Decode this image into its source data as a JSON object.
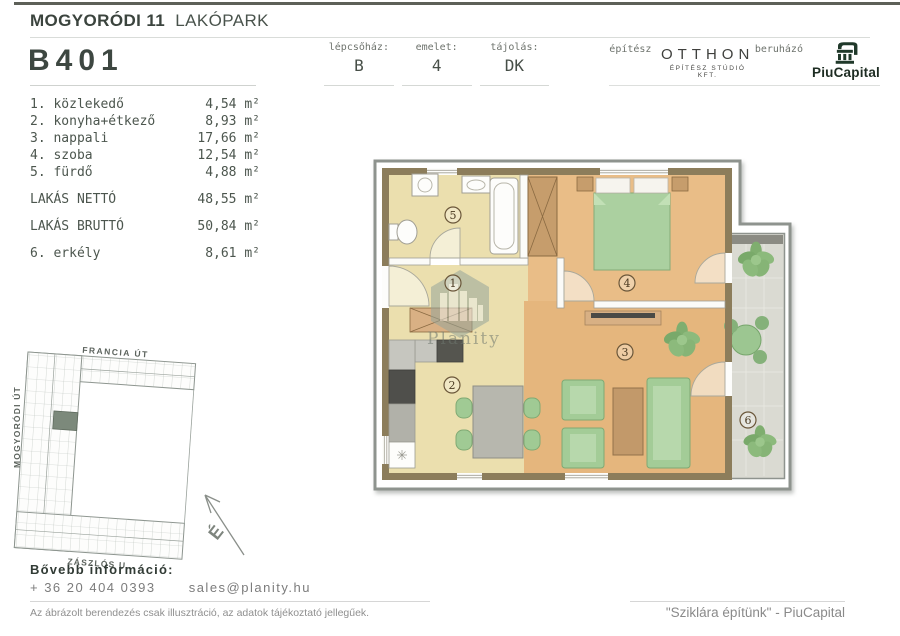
{
  "header": {
    "project_title_bold": "MOGYORÓDI 11",
    "project_title_light": "LAKÓPARK",
    "unit_id": "B401",
    "info": [
      {
        "label": "lépcsőház:",
        "value": "B"
      },
      {
        "label": "emelet:",
        "value": "4"
      },
      {
        "label": "tájolás:",
        "value": "DK"
      }
    ],
    "architect_label": "építész",
    "architect_name": "OTTHON",
    "architect_sub": "ÉPÍTÉSZ STÚDIÓ KFT.",
    "developer_label": "beruházó",
    "developer_name": "PiuCapital"
  },
  "areas": {
    "rooms": [
      {
        "label": "1. közlekedő",
        "area": "4,54 m²"
      },
      {
        "label": "2. konyha+étkező",
        "area": "8,93 m²"
      },
      {
        "label": "3. nappali",
        "area": "17,66 m²"
      },
      {
        "label": "4. szoba",
        "area": "12,54 m²"
      },
      {
        "label": "5. fürdő",
        "area": "4,88 m²"
      }
    ],
    "net": {
      "label": "LAKÁS NETTÓ",
      "area": "48,55 m²"
    },
    "gross": {
      "label": "LAKÁS BRUTTÓ",
      "area": "50,84 m²"
    },
    "balcony": {
      "label": "6. erkély",
      "area": "8,61 m²"
    }
  },
  "plan": {
    "markers": [
      "1",
      "2",
      "3",
      "4",
      "5",
      "6"
    ],
    "watermark": "Planity"
  },
  "siteplan": {
    "streets": [
      "FRANCIA ÚT",
      "MOGYORÓDI ÚT",
      "ZÁSZLÓS U."
    ],
    "north_letter": "É"
  },
  "footer": {
    "info_title": "Bővebb információ:",
    "phone": "+ 36 20 404 0393",
    "email": "sales@planity.hu",
    "disclaimer": "Az ábrázolt berendezés csak illusztráció, az adatok tájékoztató jellegűek.",
    "quote": "\"Sziklára építünk\" - PiuCapital"
  },
  "colors": {
    "brand_green": "#20392a",
    "wall_olive": "#8c7d5b",
    "floor_cream": "#ebdfae",
    "floor_wood": "#e6b77e",
    "furniture_green": "#a3cc97",
    "balcony_tile": "#dadad2"
  }
}
